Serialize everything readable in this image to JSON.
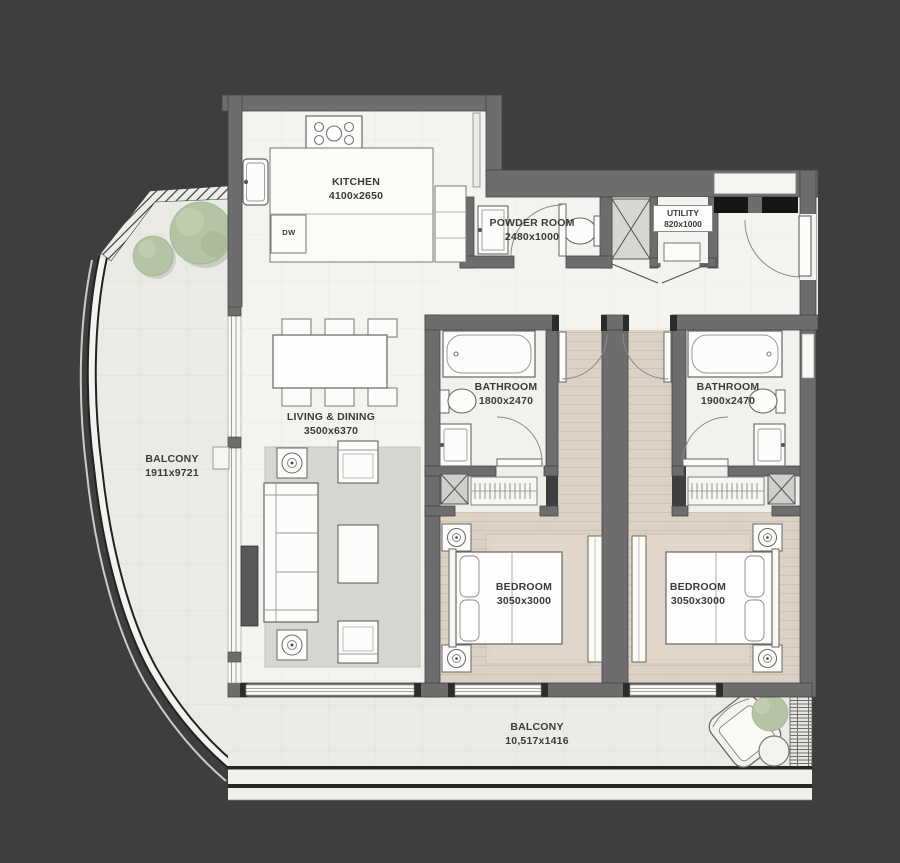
{
  "floorplan": {
    "rooms": {
      "kitchen": {
        "name": "KITCHEN",
        "dims": "4100x2650"
      },
      "powder_room": {
        "name": "POWDER ROOM",
        "dims": "2480x1000"
      },
      "utility": {
        "name": "UTILITY",
        "dims": "820x1000"
      },
      "bathroom_1": {
        "name": "BATHROOM",
        "dims": "1800x2470"
      },
      "bathroom_2": {
        "name": "BATHROOM",
        "dims": "1900x2470"
      },
      "living_dining": {
        "name": "LIVING & DINING",
        "dims": "3500x6370"
      },
      "balcony_side": {
        "name": "BALCONY",
        "dims": "1911x9721"
      },
      "bedroom_1": {
        "name": "BEDROOM",
        "dims": "3050x3000"
      },
      "bedroom_2": {
        "name": "BEDROOM",
        "dims": "3050x3000"
      },
      "balcony_bottom": {
        "name": "BALCONY",
        "dims": "10,517x1416"
      }
    },
    "appliances": {
      "dishwasher": "DW"
    },
    "colors": {
      "background": "#3e3e3e",
      "wall": "#6d6d6d",
      "floor": "#f4f3f0",
      "wood_floor": "#dbd1c5",
      "rug": "#d7d6d1",
      "plant": "#b6c4a6",
      "accent_black": "#161616"
    }
  }
}
